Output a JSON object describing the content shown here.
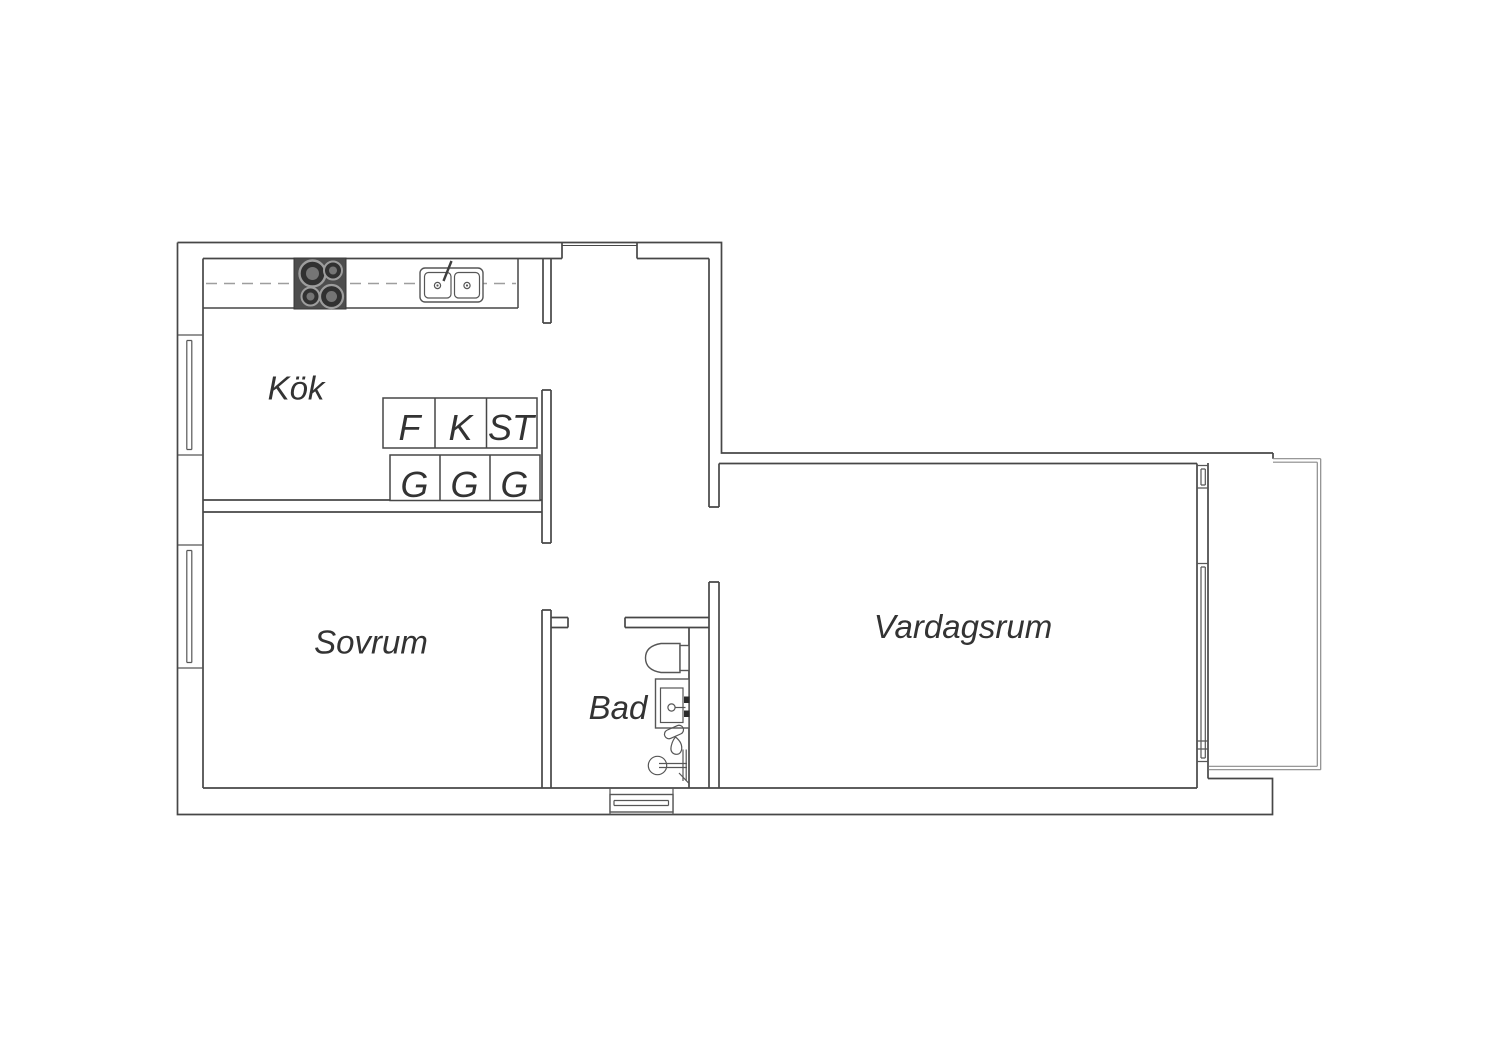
{
  "plan": {
    "rooms": {
      "kok": {
        "label": "Kök"
      },
      "sovrum": {
        "label": "Sovrum"
      },
      "bad": {
        "label": "Bad"
      },
      "vardagsrum": {
        "label": "Vardagsrum"
      }
    },
    "cabinets": {
      "f": "F",
      "k": "K",
      "st": "ST",
      "g1": "G",
      "g2": "G",
      "g3": "G"
    },
    "colors": {
      "wall": "#474747",
      "fixture": "#565656",
      "balcony": "#8a8a8a",
      "dash": "#9e9e9e",
      "stove": "#4d4d4d",
      "burner-ring": "#9d9d9d",
      "burner-dark": "#313131",
      "burner-inner": "#757575",
      "text": "#333333",
      "bg": "#ffffff"
    }
  }
}
